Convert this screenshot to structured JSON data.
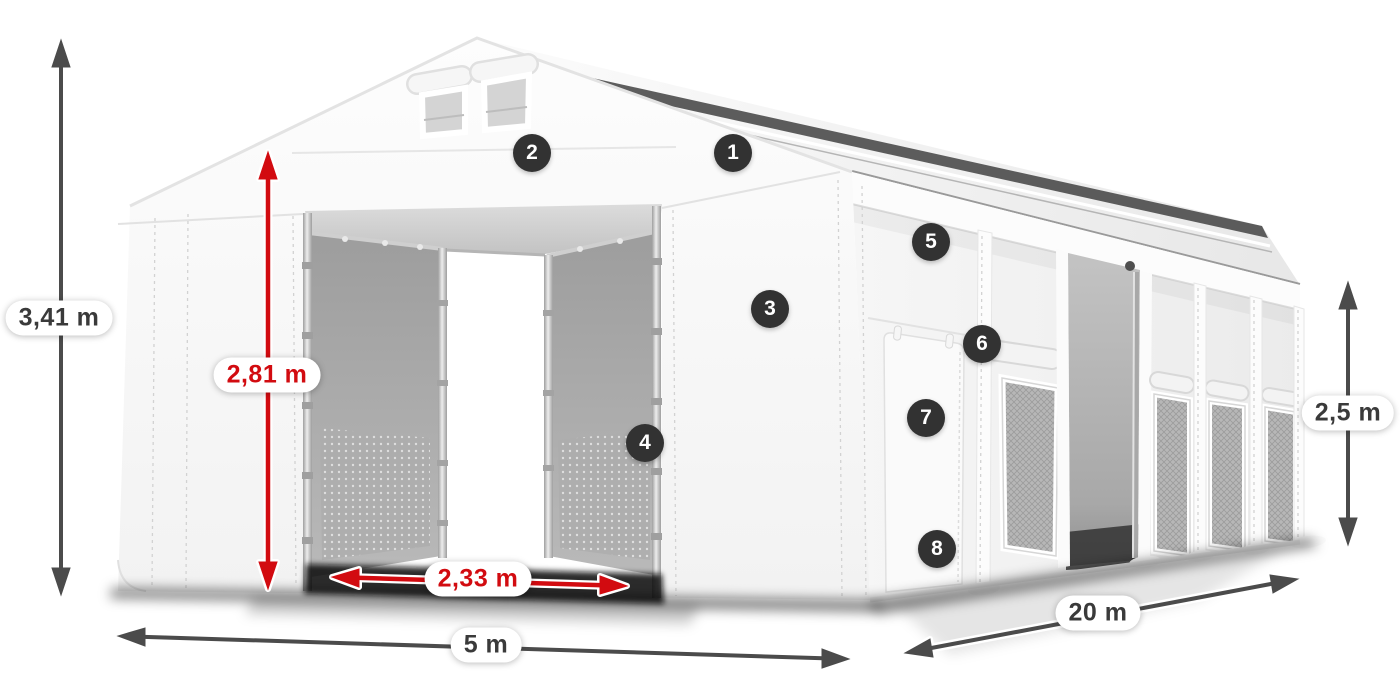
{
  "diagram": {
    "subject": "White storage tent 5x20 m with dimension annotations and numbered feature callouts",
    "dimensions": {
      "total_height": "3,41 m",
      "door_height": "2,81 m",
      "door_width": "2,33 m",
      "front_width": "5 m",
      "side_length": "20 m",
      "side_height": "2,5 m"
    },
    "callouts": [
      {
        "number": "1"
      },
      {
        "number": "2"
      },
      {
        "number": "3"
      },
      {
        "number": "4"
      },
      {
        "number": "5"
      },
      {
        "number": "6"
      },
      {
        "number": "7"
      },
      {
        "number": "8"
      }
    ],
    "colors": {
      "accent_red": "#d20b10",
      "arrow_gray": "#4b4b4b",
      "badge_background": "#323232",
      "badge_text": "#ffffff",
      "label_text": "#3a3a3a",
      "tent_fabric": "#f7f7f7"
    }
  }
}
